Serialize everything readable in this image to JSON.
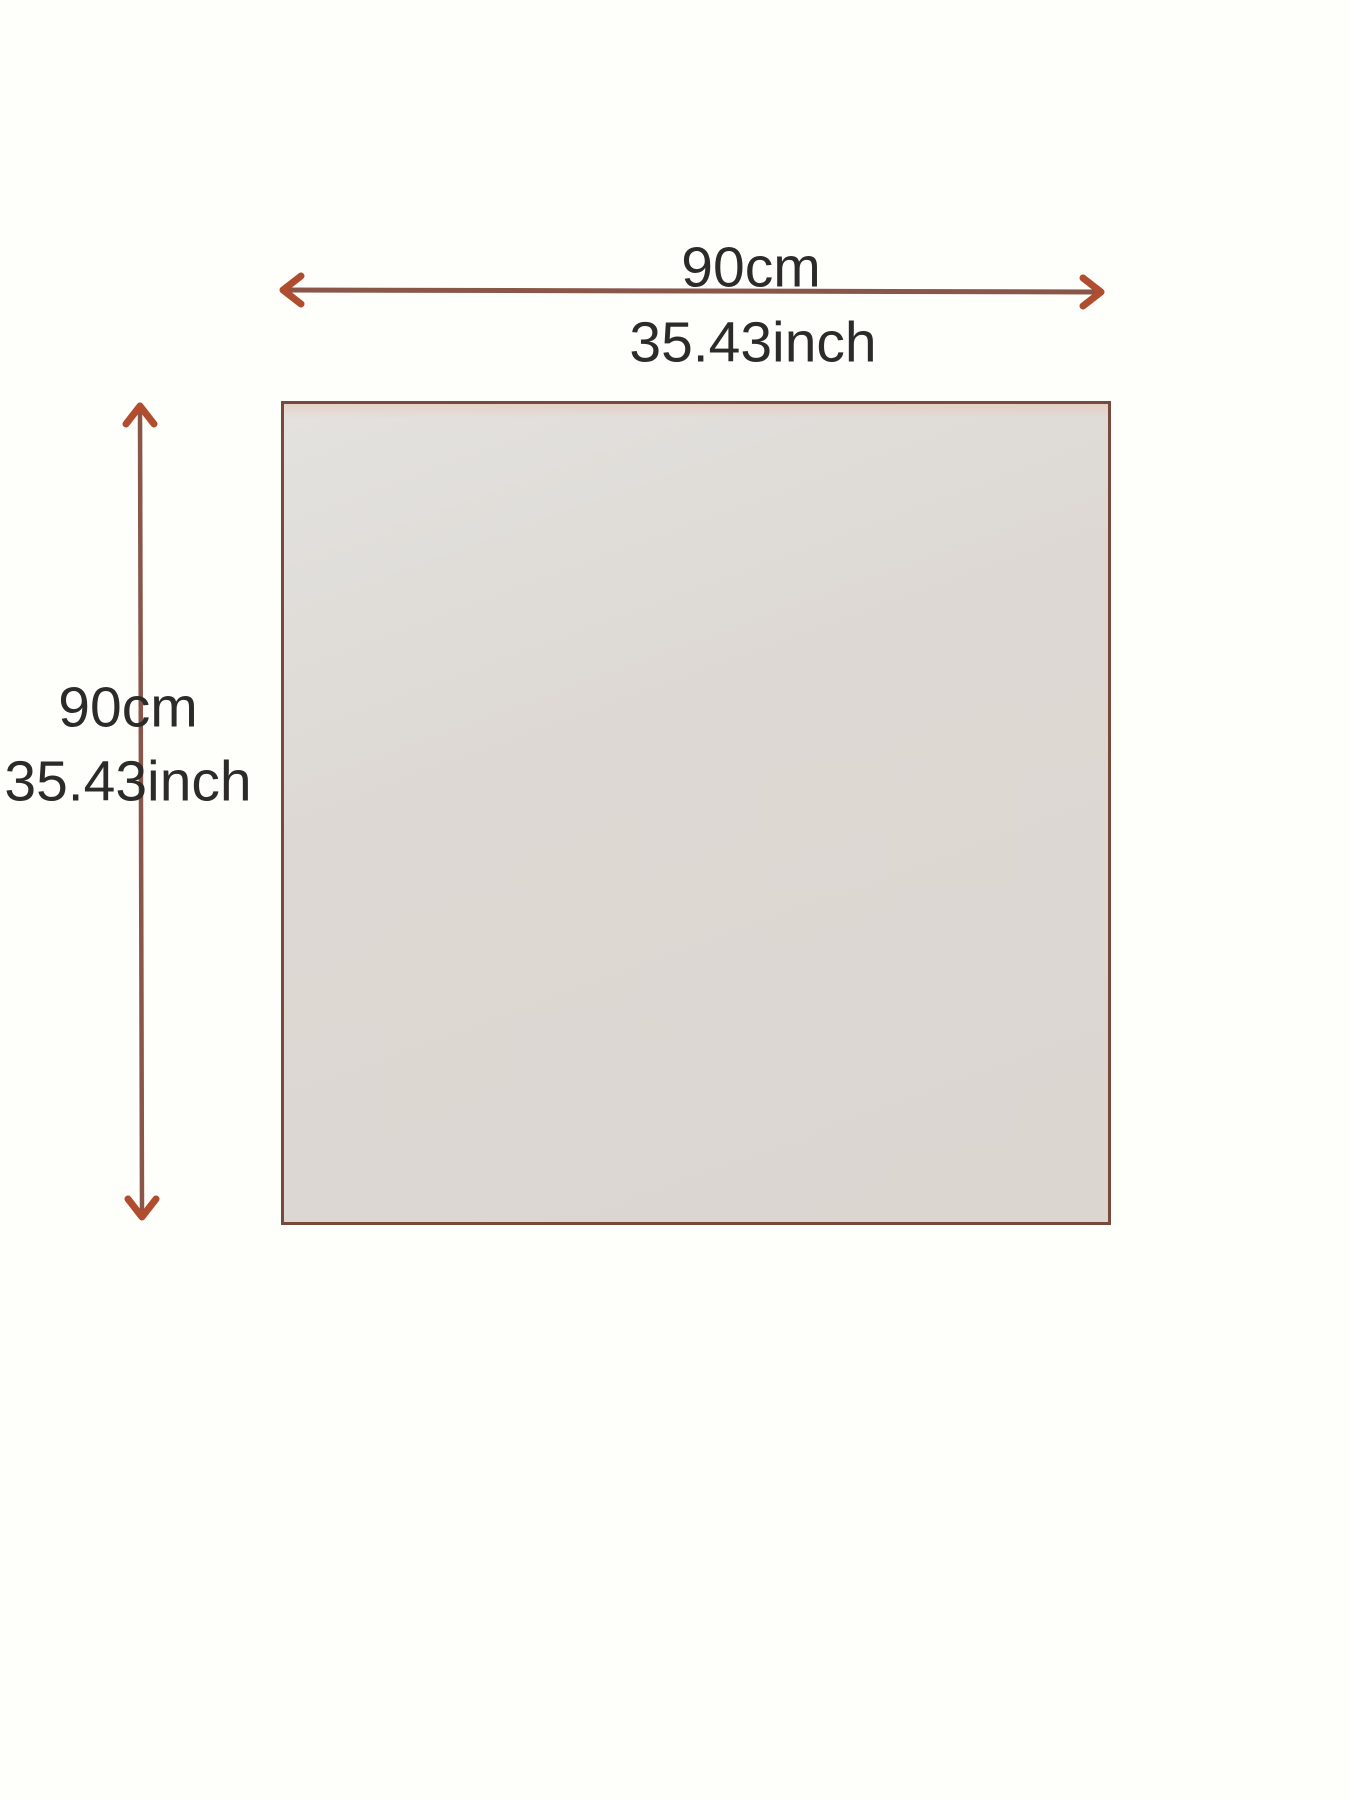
{
  "diagram": {
    "width_dimension": {
      "cm": "90cm",
      "inch": "35.43inch"
    },
    "height_dimension": {
      "cm": "90cm",
      "inch": "35.43inch"
    }
  },
  "colors": {
    "dimension_line": "#8a564a",
    "arrow_head": "#b04d2e",
    "swatch_border": "#774a3c",
    "swatch_fill": "#dcd6d1",
    "label_text": "#2d2b29",
    "background": "#fefefb"
  }
}
